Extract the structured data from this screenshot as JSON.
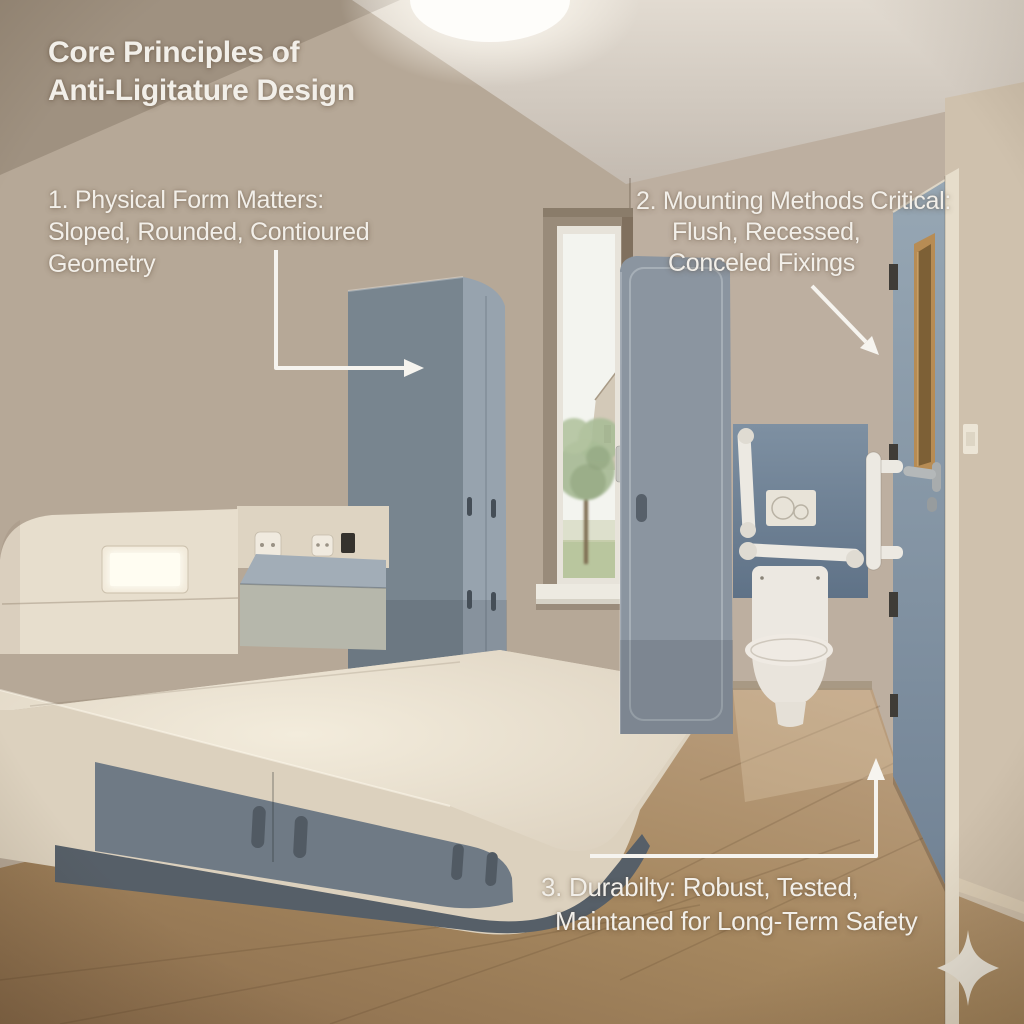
{
  "header": {
    "line1": "Core Principles of",
    "line2": "Anti-Ligitature Design"
  },
  "callouts": [
    {
      "lines": [
        "1. Physical Form Matters:",
        "Sloped, Rounded, Contioured",
        "Geometry"
      ]
    },
    {
      "lines": [
        "2. Mounting Methods Critical:",
        "Flush, Recessed,",
        "Conceled Fixings"
      ]
    },
    {
      "lines": [
        "3. Durabilty: Robust, Tested,",
        "Maintaned for Long-Term Safety"
      ]
    }
  ],
  "colors": {
    "wall": "#b6a897",
    "wall_back": "#bdafa0",
    "wall_right": "#cfc1ad",
    "ceiling_light": "#fefdfa",
    "cabinet_front": "#78858f",
    "cabinet_side": "#97a3ae",
    "cabinet_right": "#8b95a0",
    "bed_frame": "#dcd1be",
    "drawer_gray": "#6f7a85",
    "base_gray": "#565f68",
    "toilet_white": "#ece8e1",
    "rail_white": "#ece9e2",
    "door_blue": "#8da0af",
    "vision_wood": "#b78c54",
    "arrow": "#f6f4ef",
    "text": "#f2efe9",
    "sparkle": "#ece7dc",
    "floor_wood": "#a5875f"
  },
  "scene": {
    "objects": [
      "ceiling-light",
      "window-garden-view",
      "wardrobe-left",
      "wardrobe-right",
      "headboard-light",
      "power-outlets",
      "desk-surface",
      "anti-ligature-bed",
      "under-bed-drawers",
      "toilet",
      "grab-rails",
      "flush-plate",
      "door",
      "door-vision-panel",
      "door-handle",
      "light-switch",
      "sparkle-watermark"
    ]
  }
}
